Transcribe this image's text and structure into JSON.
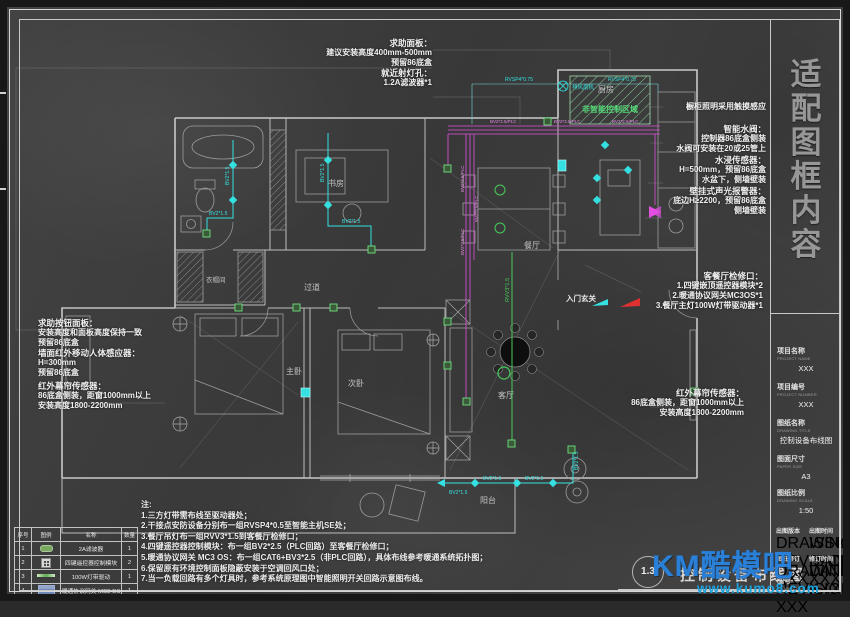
{
  "colors": {
    "cyan": "#35e0e0",
    "magenta": "#e14fe1",
    "green": "#45cc5a",
    "red": "#e03131",
    "watermark_blue": "#2a7fd6",
    "watermark_cyan": "#1aa3e0",
    "wall": "#c9c9c9"
  },
  "frame": {
    "vertical_chars": [
      "适",
      "配",
      "图",
      "框",
      "内",
      "容"
    ]
  },
  "titleblock": {
    "project_name": {
      "label": "项目名称",
      "sub": "PROJECT NAME",
      "value": "XXX"
    },
    "project_number": {
      "label": "项目编号",
      "sub": "PROJECT NUMBER",
      "value": "XXX"
    },
    "drawing_title": {
      "label": "图纸名称",
      "sub": "DRAWING TITLE",
      "value": "控制设备布线图"
    },
    "paper_size": {
      "label": "图面尺寸",
      "sub": "PAPER SIZE",
      "value": "A3"
    },
    "scale": {
      "label": "图纸比例",
      "sub": "DRAWING SCALE",
      "value": "1:50"
    },
    "revision": {
      "label": "出图版本",
      "sub": "DRAWING REVISION",
      "value": "XXX"
    },
    "issue_date": {
      "label": "出图时间",
      "sub": "ISSUE DATE",
      "value": "XXX"
    },
    "drawing_revision": {
      "label": "图纸修订",
      "sub": "DRAWING REVISION",
      "value": "XXX"
    },
    "revision_date": {
      "label": "修订时间",
      "sub": "DATE",
      "value": "XXX"
    },
    "drawing_no": {
      "label": "图号",
      "sub": "DRAWING NO.",
      "value": "1.3"
    }
  },
  "legend": {
    "headers": [
      "序号",
      "图例",
      "名称",
      "数量"
    ],
    "rows": [
      {
        "no": "1",
        "icon": "filter-capsule-icon",
        "name": "2A滤波器",
        "qty": "1"
      },
      {
        "no": "2",
        "icon": "keypad-module-icon",
        "name": "四键遥控器控制模块",
        "qty": "2"
      },
      {
        "no": "3",
        "icon": "led-strip-driver-icon",
        "name": "100W灯带驱动",
        "qty": "1"
      },
      {
        "no": "4",
        "icon": "hvac-gateway-icon",
        "name": "暖通协议网关 MC3 OS",
        "qty": "1"
      }
    ]
  },
  "notes": {
    "title": "注:",
    "items": [
      "1.三方灯带需布线至驱动器处；",
      "2.干接点安防设备分别布一组RVSP4*0.5至智能主机SE处；",
      "3.餐厅吊灯布一组RVV3*1.5到客餐厅检修口；",
      "4.四键遥控器控制模块：布一组BV2*2.5（PLC回路）至客餐厅检修口；",
      "5.暖通协议网关 MC3 OS：布一组CAT6+BV3*2.5（非PLC回路），具体布线参考暖通系统拓扑图；",
      "6.保留原有环境控制面板隐蔽安装于空调回风口处；",
      "7.当一负载回路有多个灯具时，参考系统原理图中智能照明开关回路示意图布线。"
    ]
  },
  "annotations": {
    "help_panel": {
      "title": "求助面板：",
      "l1": "建议安装高度400mm-500mm",
      "l2": "预留86底盒",
      "sub": "就近射灯孔：",
      "l3": "1.2A滤波器*1"
    },
    "cabinet": {
      "l1": "橱柜照明采用触摸感应"
    },
    "valve": {
      "title": "智能水阀：",
      "l1": "控制器86底盒侧装",
      "l2": "水阀可安装在20或25管上"
    },
    "flood": {
      "title": "水浸传感器：",
      "l1": "H=500mm，预留86底盒",
      "l2": "水盆下，侧墙壁装"
    },
    "alarm": {
      "title": "壁挂式声光报警器：",
      "l1": "底边H≥2200，预留86底盒",
      "l2": "侧墙壁装"
    },
    "inspection": {
      "title": "客餐厅检修口：",
      "l1": "1.四键嵌顶遥控器模块*2",
      "l2": "2.暖通协议网关MC3OS*1",
      "l3": "3.餐厅主灯100W灯带驱动器*1"
    },
    "ir_right": {
      "title": "红外幕帘传感器：",
      "l1": "86底盒侧装，距窗1000mm以上",
      "l2": "安装高度1800-2200mm"
    },
    "help_button": {
      "title": "求助按钮面板：",
      "l1": "安装高度和面板高度保持一致",
      "l2": "预留86底盒"
    },
    "pir": {
      "title": "墙面红外移动人体感应器：",
      "l1": "H=300mm",
      "l2": "预留86底盒"
    },
    "ir_left": {
      "title": "红外幕帘传感器：",
      "l1": "86底盒侧装，距窗1000mm以上",
      "l2": "安装高度1800-2200mm"
    }
  },
  "plan": {
    "rooms": {
      "kitchen": "厨房",
      "dining": "餐厅",
      "study": "书房",
      "hall": "过道",
      "cloak": "衣帽间",
      "master": "主卧",
      "second": "次卧",
      "living": "客厅",
      "balcony": "阳台"
    },
    "entry_label": "入门玄关",
    "zone_label": "非智能控制区域",
    "fan_label": "排风扇机",
    "wires": {
      "bv215": "BV2*1.5",
      "plc": "BV2*2.5/PLC",
      "rvv": "RVV3*1.5",
      "rvsp": "RVSP4*0.75"
    }
  },
  "footer": {
    "page_no": "1.3",
    "title": "控制设备布线图"
  },
  "watermark": {
    "brand": "KM酷模吧",
    "url": "www.kumo8.com"
  }
}
